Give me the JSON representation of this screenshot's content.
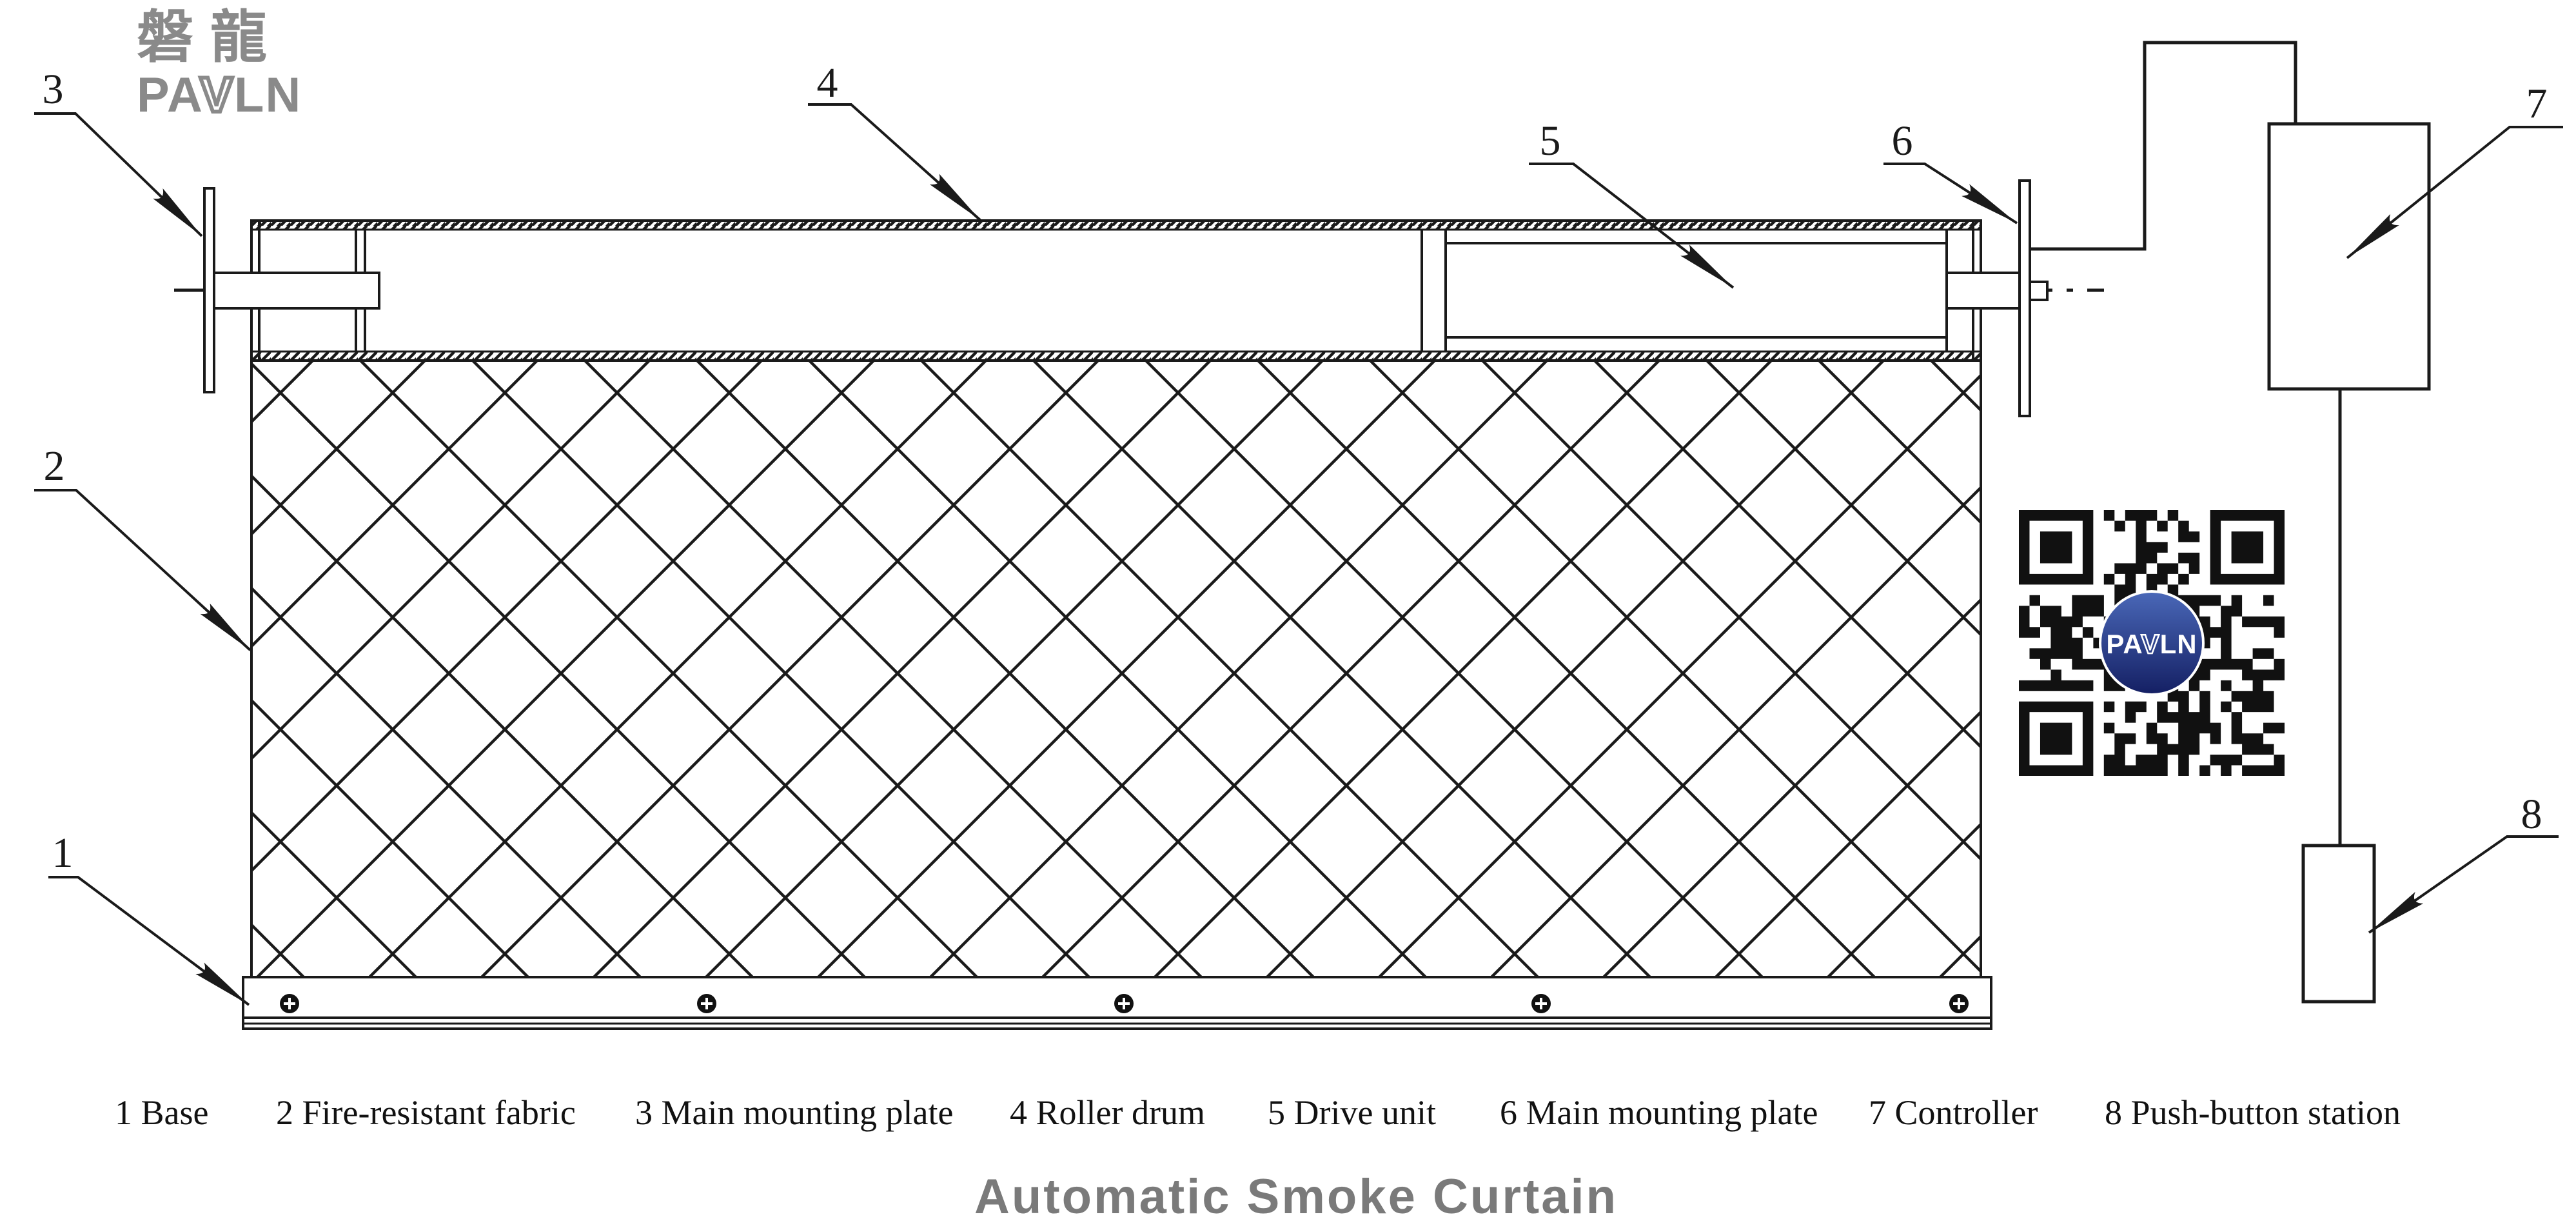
{
  "title": "Automatic Smoke Curtain",
  "logo": {
    "cjk": "磐龍",
    "latin": "PAVLN",
    "latin_parts": [
      "PA",
      "V",
      "LN"
    ]
  },
  "callouts": [
    "1",
    "2",
    "3",
    "4",
    "5",
    "6",
    "7",
    "8"
  ],
  "legend": {
    "items": [
      "1 Base",
      "2 Fire-resistant fabric",
      "3 Main mounting plate",
      "4 Roller drum",
      "5 Drive unit",
      "6 Main mounting plate",
      "7 Controller",
      "8 Push-button station"
    ]
  },
  "qr": {
    "icon": "qr-code",
    "label_parts": [
      "PA",
      "V",
      "LN"
    ]
  },
  "colors": {
    "line": "#1a1a1a",
    "logo_gray": "#8a8a8a",
    "title_gray": "#7a7a7a",
    "qr_black": "#111111",
    "qr_badge_blue_top": "#4a68b8",
    "qr_badge_blue_bottom": "#141f63",
    "background": "#ffffff"
  }
}
